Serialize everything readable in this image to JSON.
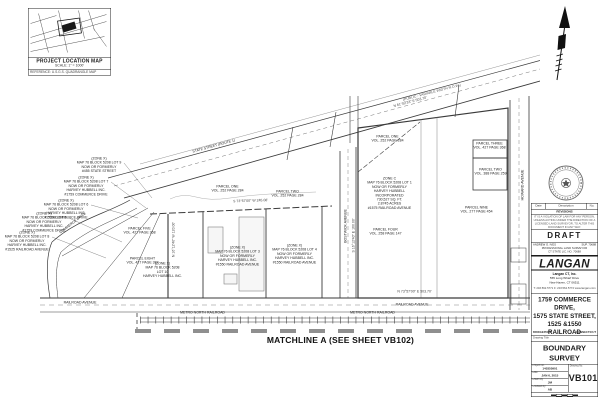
{
  "location_map": {
    "title": "PROJECT LOCATION MAP",
    "scale": "SCALE: 1\" = 1000'",
    "note": "REFERENCE: U.S.G.S. QUADRANGLE MAP"
  },
  "drawing": {
    "roads": {
      "state_street": "STATE STREET  (ROUTE 1)",
      "state_street_row": "(PUBLIC - VARIABLE WIDTH R.O.W.)",
      "commerce_drive": "COMMERCE DRIVE",
      "bostwick_avenue": "BOSTWICK AVENUE",
      "howard_avenue": "HOWARD AVENUE",
      "railroad_avenue_west": "RAILROAD AVENUE",
      "railroad_avenue_east": "RAILROAD AVENUE",
      "metro_north_west": "METRO NORTH RAILROAD",
      "metro_north_east": "METRO NORTH RAILROAD"
    },
    "matchline": "MATCHLINE A (SEE SHEET VB102)",
    "annotations": [
      "(ZONE X)\nMAP 76 BLOCK 5208 LOT 9\nNOW OR FORMERLY\n#455 STATE STREET",
      "(ZONE X)\nMAP 76 BLOCK 5208 LOT 7\nNOW OR FORMERLY\nHARVEY HUBBELL INC.\n#1759 COMMERCE DRIVE",
      "(ZONE X)\nMAP 76 BLOCK 5208 LOT 6\nNOW OR FORMERLY\nHARVEY HUBBELL INC.\n#1759 COMMERCE DRIVE",
      "(ZONE X)\nMAP 76 BLOCK 5208 LOT 5\nNOW OR FORMERLY\nHARVEY HUBBELL INC.\n#1759 COMMERCE DRIVE",
      "(ZONE X)\nMAP 76 BLOCK 5208 LOT 8\nNOW OR FORMERLY\nHARVEY HUBBELL INC.\n#1525 RAILROAD AVENUE"
    ],
    "parcels": [
      "PARCEL ONE\nVOL. 252 PAGE 284",
      "PARCEL TWO\nVOL. 252 PAGE 284",
      "PARCEL ONE\nVOL. 252 PAGE 284",
      "PARCEL FOUR\nVOL. 258 PAGE 147",
      "PARCEL THREE\nVOL. 427 PAGE 368",
      "PARCEL TWO\nVOL. 388 PAGE 259",
      "PARCEL NINE\nVOL. 277 PAGE 454",
      "PARCEL FIVE\nVOL. 427 PAGE 368",
      "PARCEL EIGHT\nVOL. 427 PAGE 387"
    ],
    "lots": [
      "ZONE C\nMAP 76 BLOCK 5208 LOT 1\nNOW OR FORMERLY\nHARVEY HUBBELL INCORPORATED\n730,527 SQ. FT.\n2.8745 ACRES\n#1575 RAILROAD AVENUE",
      "(ZONE X)\nMAP 76 BLOCK 5208 LOT 3\nNOW OR FORMERLY\nHARVEY HUBBELL INC.\n#1550 RAILROAD AVENUE",
      "(ZONE X)\nMAP 76 BLOCK 5208 LOT 4\nNOW OR FORMERLY\nHARVEY HUBBELL INC.\n#1550 RAILROAD AVENUE",
      "(ZONE X)\nMAP 76 BLOCK 5208\nLOT 10\nHARVEY HUBBELL INC."
    ],
    "bearings": [
      "N 61°02'33\" E  503.70'",
      "S 73°57'00\" W  245.08'",
      "S 16°12'40\" E  160.00'",
      "N 73°57'00\" E  503.70'",
      "N 16°12'40\" W  120.00'"
    ]
  },
  "title_block": {
    "revisions": {
      "date_label": "Date",
      "description_label": "Description",
      "no_label": "No.",
      "title": "REVISIONS",
      "note": "IT IS A VIOLATION OF LAW FOR ANY PERSON, UNLESS ACTING UNDER THE DIRECTION OF A LICENSED LAND SURVEYOR, TO ALTER THIS DOCUMENT IN ANY WAY."
    },
    "draft": "DRAFT",
    "surveyor_name": "ANDREW G. IVES",
    "surveyor_no": "SUP. 70688",
    "surveyor_title": "PROFESSIONAL LAND SURVEYOR",
    "surveyor_lic": "CT STATE LIC. NO. 70688",
    "logo": "LANGAN",
    "firm_name": "Langan CT, Inc.",
    "firm_addr1": "555 Long Wharf Drive",
    "firm_addr2": "New Haven, CT 06511",
    "firm_contact": "T: 203.562.5771   F: 203.562.5772   www.langan.com",
    "project_name": "1759 COMMERCE DRIVE,\n1575 STATE STREET,\n1525 &1550 RAILROAD\nAVENUE",
    "locality_left": "BRIDGEPORT",
    "locality_right": "CONNECTICUT",
    "drawing_title_label": "Drawing Title",
    "drawing_title": "BOUNDARY\nSURVEY",
    "fields": {
      "project_no_label": "Project No.",
      "project_no": "140355901",
      "date_label": "Date",
      "date": "JAN 6, 2015",
      "drawn_label": "Drawn By",
      "drawn": "JM",
      "checked_label": "Checked By",
      "checked": "AB",
      "drawing_no_label": "Drawing No.",
      "drawing_no": "VB101"
    }
  }
}
